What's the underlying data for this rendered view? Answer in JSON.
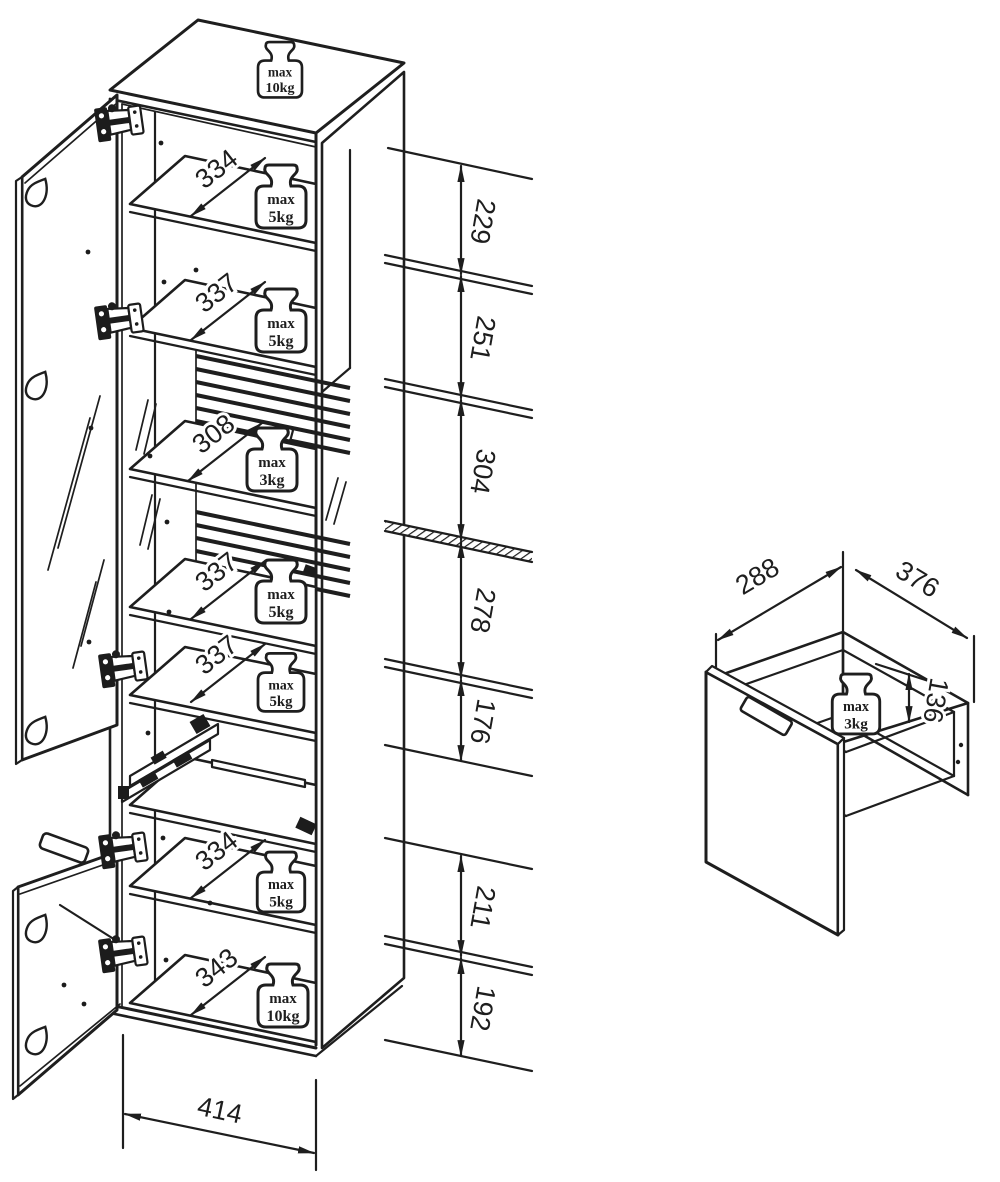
{
  "cabinet": {
    "top_load": {
      "l1": "max",
      "l2": "10kg"
    },
    "shelves": [
      {
        "size": "334",
        "load_l1": "max",
        "load_l2": "5kg"
      },
      {
        "size": "337",
        "load_l1": "max",
        "load_l2": "5kg"
      },
      {
        "size": "308",
        "load_l1": "max",
        "load_l2": "3kg"
      },
      {
        "size": "337",
        "load_l1": "max",
        "load_l2": "5kg"
      },
      {
        "size": "337",
        "load_l1": "max",
        "load_l2": "5kg"
      },
      {
        "size": "334",
        "load_l1": "max",
        "load_l2": "5kg"
      },
      {
        "size": "343",
        "load_l1": "max",
        "load_l2": "10kg"
      }
    ],
    "heights": [
      "229",
      "251",
      "304",
      "278",
      "176",
      "211",
      "192"
    ],
    "width": "414"
  },
  "drawer": {
    "width": "288",
    "depth": "376",
    "height": "136",
    "load": {
      "l1": "max",
      "l2": "3kg"
    }
  }
}
